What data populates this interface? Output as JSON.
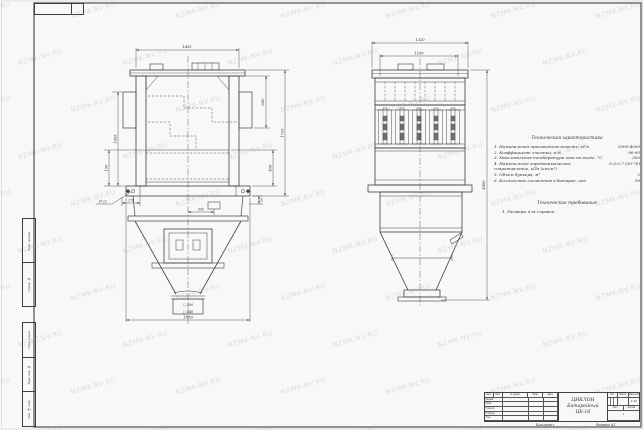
{
  "watermark": {
    "text": "NZMK-NV.RU"
  },
  "colors": {
    "paper": "#f8f8f6",
    "line": "#3f3f42",
    "dim": "#4a4a4a",
    "watermark": "#96a5b9"
  },
  "corner_stamp": {
    "value": ""
  },
  "side_stamps": {
    "upper": [
      "Перв. примен.",
      "Справ. №"
    ],
    "lower": [
      "Подп. и дата",
      "Взам. инв. №",
      "Инв. № подл."
    ]
  },
  "front_view": {
    "dim_top_width": "1435",
    "dim_right_inner": "600",
    "dim_right_lower": "450",
    "dim_right_overall": "1735",
    "dim_left_height": "1005",
    "dim_left_lower": "150",
    "dim_hole": "Ø 22",
    "dim_base_left": "270",
    "dim_port_offset": "300",
    "dim_right_small": "60",
    "dim_outlet_inner": "□ 400",
    "dim_outlet_outer": "□ 440",
    "dim_bottom_width": "1800"
  },
  "side_view": {
    "dim_top_outer": "1320",
    "dim_top_inner": "1100",
    "dim_height_overall": "4400"
  },
  "tech_chars": {
    "title": "Техническая характеристика",
    "items": [
      {
        "text": "1. Номинальная производительность, м³/ч",
        "value": "2000-4000"
      },
      {
        "text": "2. Коэффициент очистки, в %",
        "value": "90-95"
      },
      {
        "text": "3. Максимальная температура газа на входе, °С",
        "value": "300"
      },
      {
        "text": "4. Номинальное аэродинамическое сопротивление, кПа (кгс/м²)",
        "value": "0,5-0,7 (50-70)"
      },
      {
        "text": "5. Объем бункера, м³",
        "value": "2"
      },
      {
        "text": "6. Количество элементов в батарее, шт",
        "value": "16"
      }
    ]
  },
  "tech_reqs": {
    "title": "Технические требования",
    "items": [
      "1. Размеры для справок."
    ]
  },
  "title_block": {
    "header_cols": [
      "Изм.",
      "Лист",
      "№ докум.",
      "Подп.",
      "Дата"
    ],
    "row_labels": [
      "Разраб.",
      "Пров.",
      "Т.контр.",
      "Н.контр.",
      "Утв."
    ],
    "name_line1": "ЦИКЛОН",
    "name_line2": "Батарейный",
    "name_line3": "ЦБ-16",
    "lit_label": "Лит.",
    "mass_label": "Масса",
    "scale_label": "Масштаб",
    "scale_value": "1:10",
    "sheet_label": "Лист",
    "sheets_label": "Листов",
    "sheets_value": "1",
    "copied_label": "Копировал",
    "format_label": "Формат А1"
  }
}
